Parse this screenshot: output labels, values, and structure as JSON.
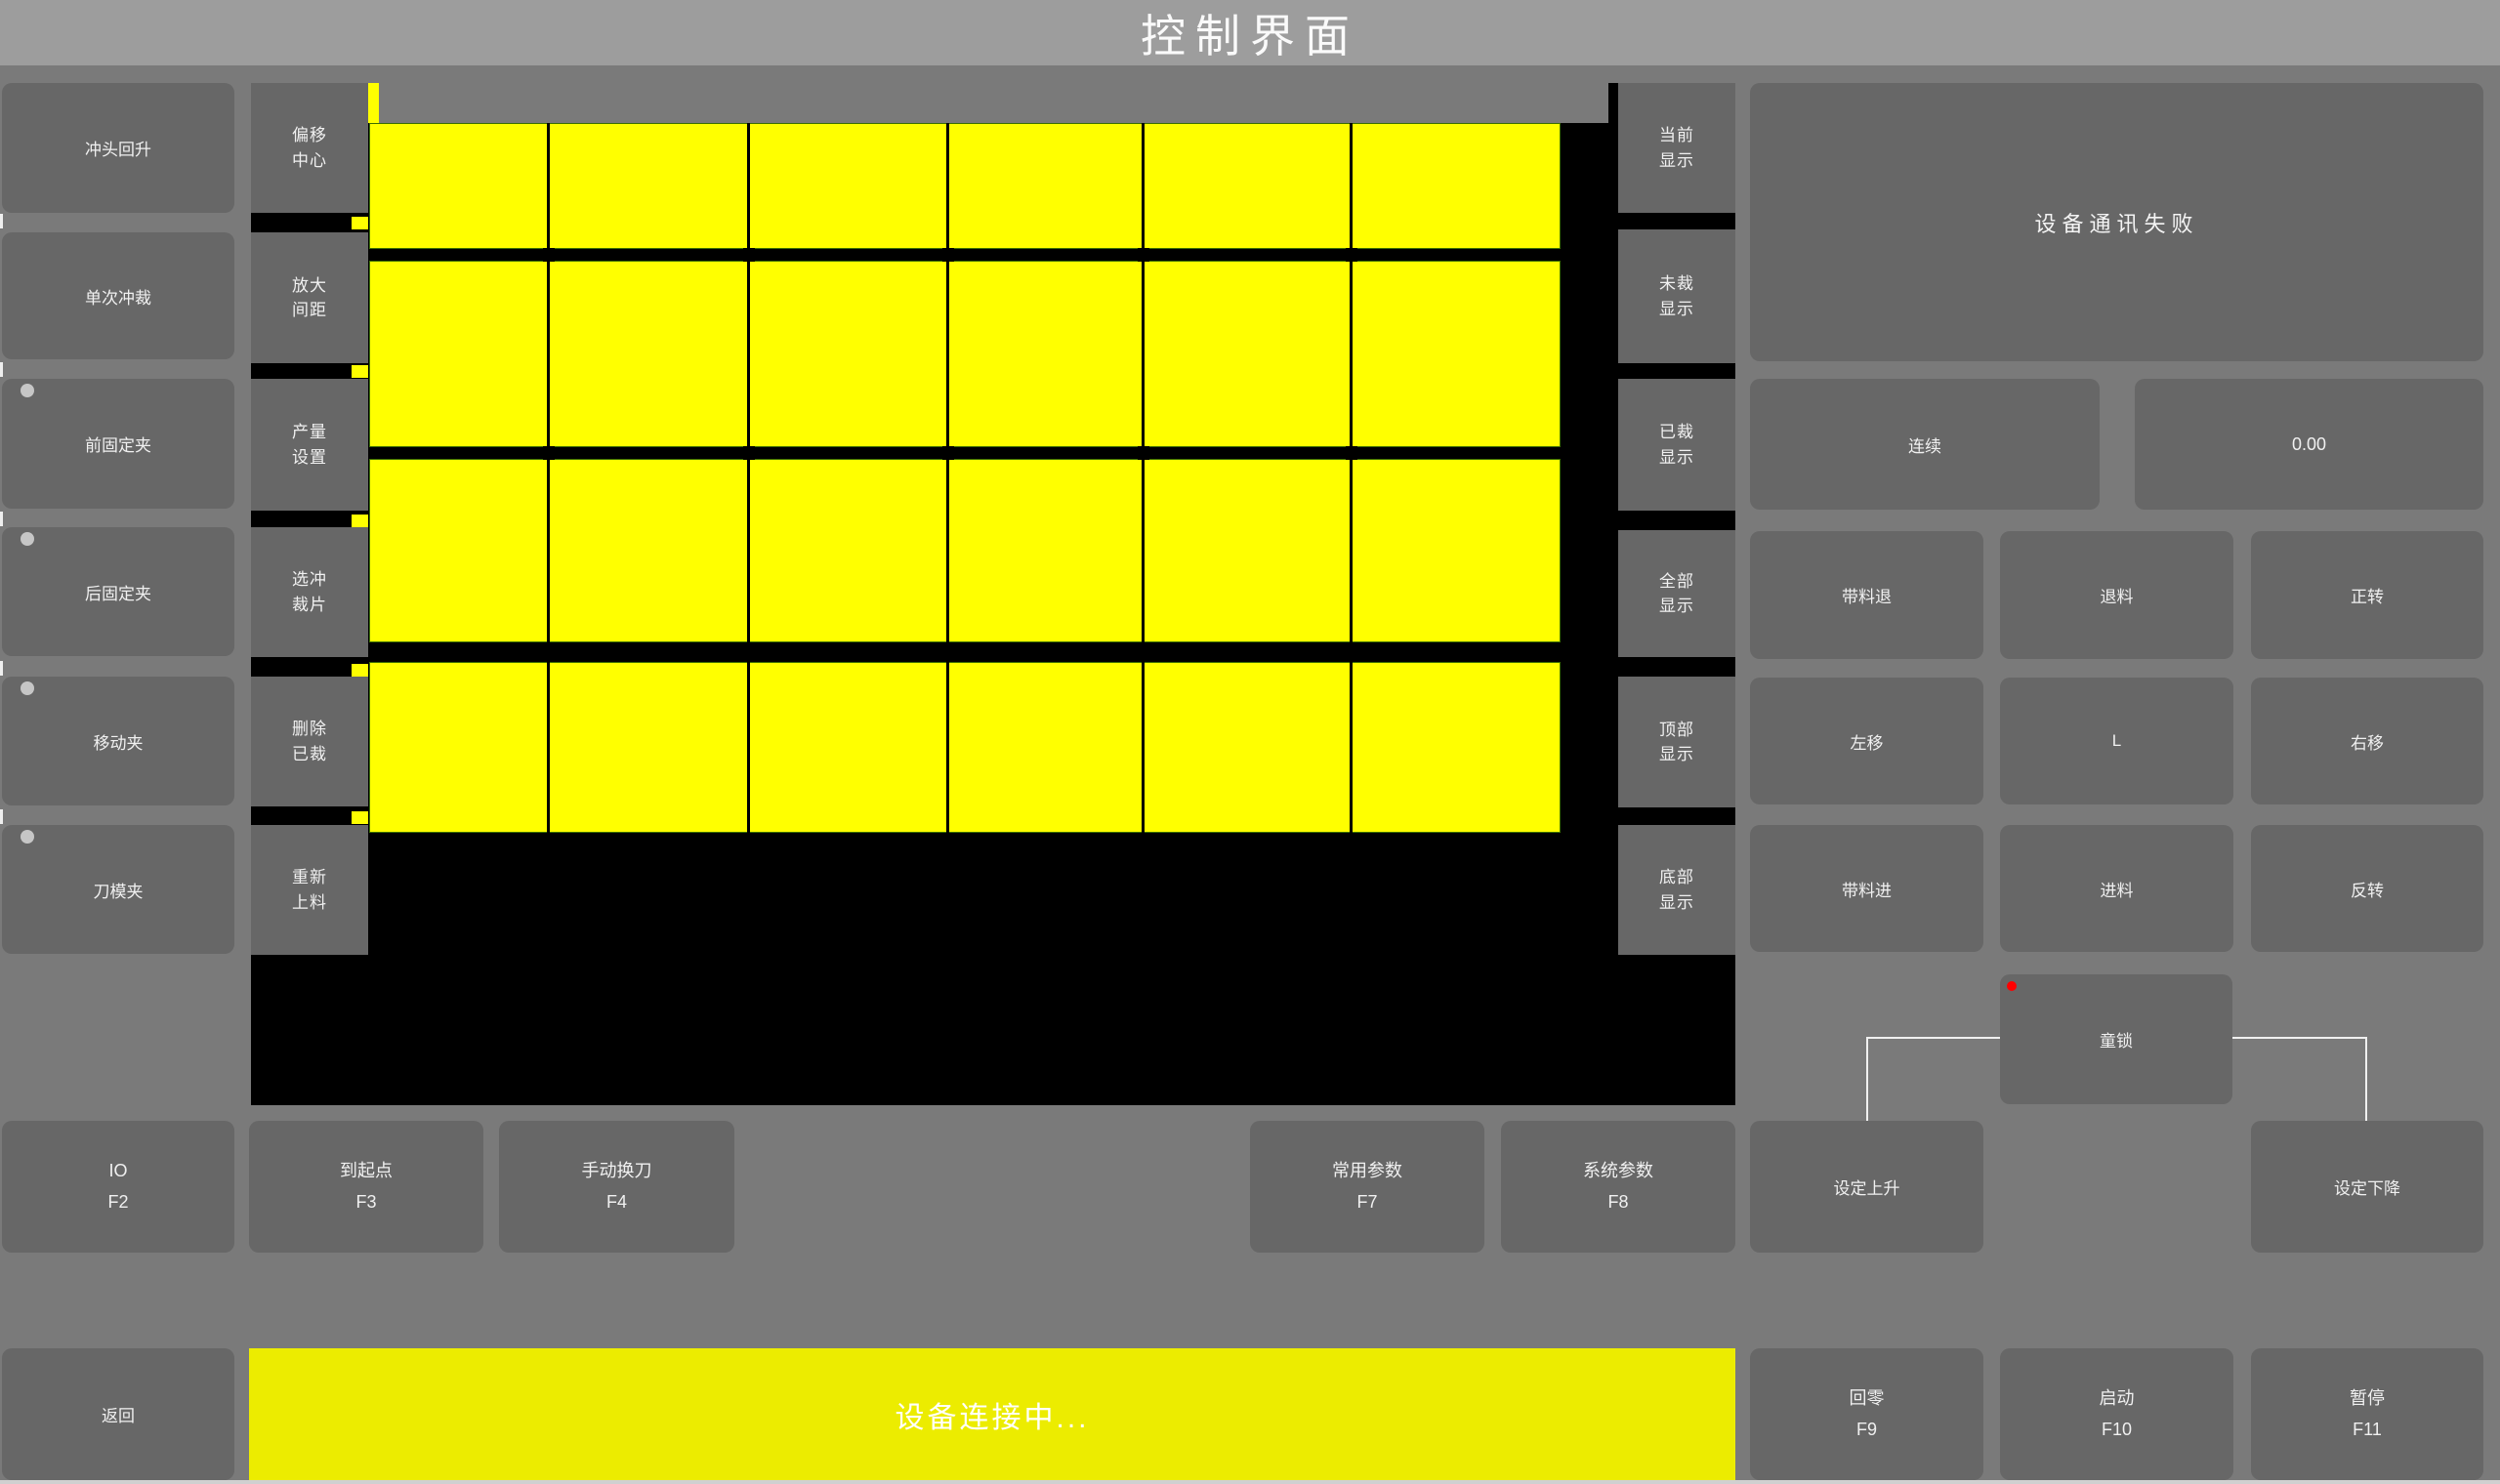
{
  "window": {
    "title": "控制界面"
  },
  "left_nav": {
    "items": [
      {
        "label": "冲头回升"
      },
      {
        "label": "单次冲裁"
      },
      {
        "label": "前固定夹"
      },
      {
        "label": "后固定夹"
      },
      {
        "label": "移动夹"
      },
      {
        "label": "刀模夹"
      }
    ]
  },
  "tool_column": {
    "items": [
      {
        "label": "偏移\n中心"
      },
      {
        "label": "放大\n间距"
      },
      {
        "label": "产量\n设置"
      },
      {
        "label": "选冲\n裁片"
      },
      {
        "label": "删除\n已裁"
      },
      {
        "label": "重新\n上料"
      }
    ]
  },
  "display_column": {
    "items": [
      {
        "label": "当前\n显示"
      },
      {
        "label": "未裁\n显示"
      },
      {
        "label": "已裁\n显示"
      },
      {
        "label": "全部\n显示"
      },
      {
        "label": "顶部\n显示"
      },
      {
        "label": "底部\n显示"
      }
    ]
  },
  "right_panel": {
    "message": "设备通讯失败",
    "mode_button": "连续",
    "value_display": "0.00",
    "jog": {
      "feed_back": "带料退",
      "unload": "退料",
      "forward_rotate": "正转",
      "move_left": "左移",
      "center": "L",
      "move_right": "右移",
      "feed_in": "带料进",
      "load": "进料",
      "reverse_rotate": "反转"
    },
    "child_lock": "童锁",
    "set_rise": "设定上升",
    "set_fall": "设定下降"
  },
  "function_row": {
    "items": [
      {
        "label": "IO",
        "key": "F2"
      },
      {
        "label": "到起点",
        "key": "F3"
      },
      {
        "label": "手动换刀",
        "key": "F4"
      },
      {
        "label": "常用参数",
        "key": "F7"
      },
      {
        "label": "系统参数",
        "key": "F8"
      }
    ]
  },
  "bottom_bar": {
    "back": "返回",
    "status": "设备连接中...",
    "home": {
      "label": "回零",
      "key": "F9"
    },
    "start": {
      "label": "启动",
      "key": "F10"
    },
    "pause": {
      "label": "暂停",
      "key": "F11"
    }
  },
  "colors": {
    "sheet_yellow": "#ffff00",
    "status_bar_yellow": "#ecec00",
    "alert_dot_red": "#ff0000",
    "indicator_dot_gray": "#c6c6c6",
    "button_gray": "#676767",
    "title_bar_gray": "#9d9d9d",
    "canvas_black": "#000000"
  }
}
